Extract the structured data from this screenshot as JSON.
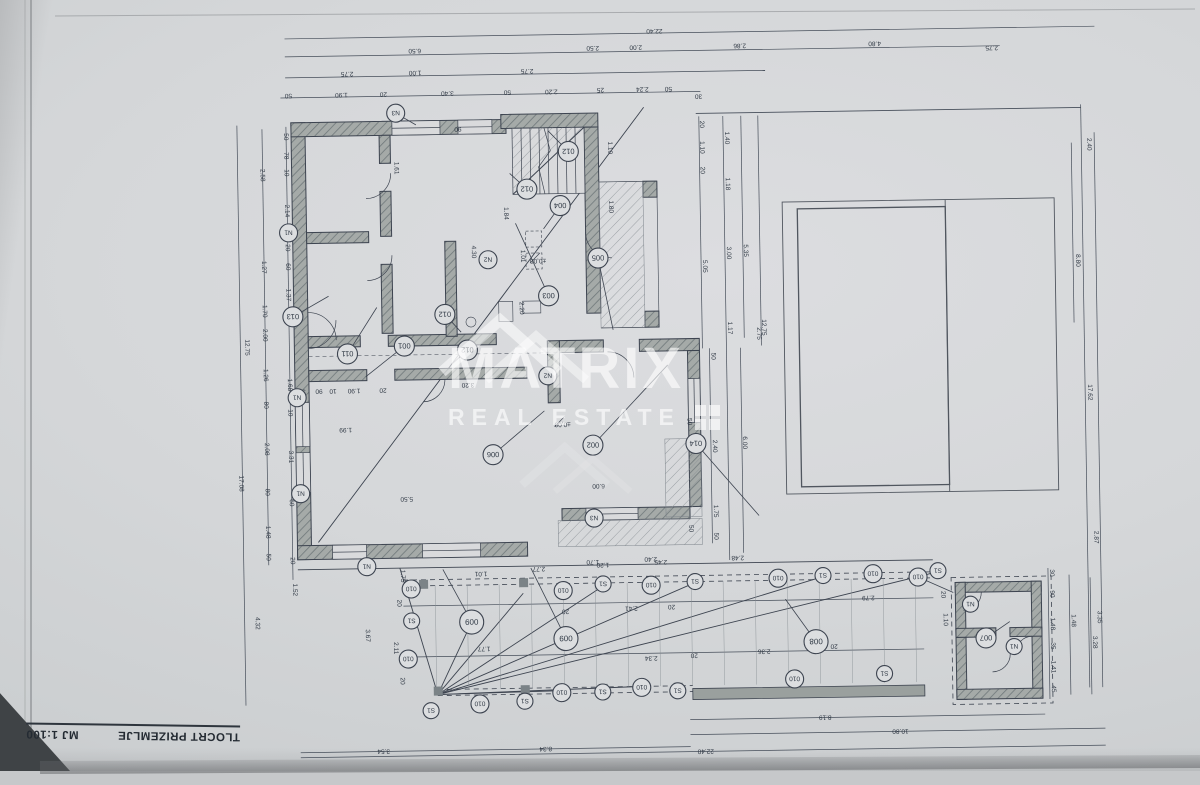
{
  "title_block": {
    "title": "TLOCRT PRIZEMLJE",
    "scale": "MJ 1:100"
  },
  "watermark": {
    "brand": "MATRIX",
    "tagline": "REAL ESTATE"
  },
  "colors": {
    "paper": "#d5d7d9",
    "ink": "#3d4450",
    "wall": "#a5aaa8",
    "hatch": "#6f787a",
    "watermark_white": "rgba(255,255,255,0.62)"
  },
  "levels": [
    {
      "t": "±0,00",
      "x": 540,
      "y": 258
    },
    {
      "t": "±0,00",
      "x": 562,
      "y": 422
    }
  ],
  "tags": [
    {
      "t": "N3",
      "x": 400,
      "y": 110,
      "r": 9,
      "lx": 420,
      "ly": 122
    },
    {
      "t": "N1",
      "x": 291,
      "y": 228,
      "r": 9
    },
    {
      "t": "013",
      "x": 294,
      "y": 312,
      "r": 10,
      "lx": 330,
      "ly": 292
    },
    {
      "t": "011",
      "x": 348,
      "y": 350,
      "r": 10,
      "lx": 378,
      "ly": 304
    },
    {
      "t": "001",
      "x": 405,
      "y": 343,
      "r": 10,
      "lx": 366,
      "ly": 373
    },
    {
      "t": "012",
      "x": 572,
      "y": 151,
      "r": 10,
      "lx": 552,
      "ly": 130
    },
    {
      "t": "012",
      "x": 530,
      "y": 188,
      "r": 10,
      "lx": 513,
      "ly": 172
    },
    {
      "t": "012",
      "x": 446,
      "y": 312,
      "r": 10,
      "lx": 462,
      "ly": 330
    },
    {
      "t": "012",
      "x": 468,
      "y": 348,
      "r": 10,
      "lx": 452,
      "ly": 362
    },
    {
      "t": "004",
      "x": 563,
      "y": 205,
      "r": 10,
      "lx": 546,
      "ly": 228
    },
    {
      "t": "005",
      "x": 600,
      "y": 258,
      "r": 10,
      "lx": 614,
      "ly": 330
    },
    {
      "t": "003",
      "x": 550,
      "y": 295,
      "r": 10,
      "lx": 518,
      "ly": 222
    },
    {
      "t": "006",
      "x": 492,
      "y": 453,
      "r": 10,
      "lx": 544,
      "ly": 410
    },
    {
      "t": "002",
      "x": 592,
      "y": 445,
      "r": 10,
      "lx": 668,
      "ly": 366
    },
    {
      "t": "014",
      "x": 695,
      "y": 445,
      "r": 10,
      "lx": 757,
      "ly": 518
    },
    {
      "t": "N2",
      "x": 490,
      "y": 258,
      "r": 9
    },
    {
      "t": "N2",
      "x": 548,
      "y": 375,
      "r": 9
    },
    {
      "t": "N3",
      "x": 592,
      "y": 518,
      "r": 9
    },
    {
      "t": "N1",
      "x": 297,
      "y": 393,
      "r": 9
    },
    {
      "t": "N1",
      "x": 299,
      "y": 489,
      "r": 9
    },
    {
      "t": "N1",
      "x": 364,
      "y": 563,
      "r": 9
    },
    {
      "t": "N1",
      "x": 967,
      "y": 610,
      "r": 8
    },
    {
      "t": "N1",
      "x": 1010,
      "y": 653,
      "r": 8
    },
    {
      "t": "007",
      "x": 982,
      "y": 644,
      "r": 10,
      "lx": 1006,
      "ly": 628
    },
    {
      "t": "010",
      "x": 915,
      "y": 582,
      "r": 9,
      "lx": 950,
      "ly": 598
    },
    {
      "t": "010",
      "x": 408,
      "y": 586,
      "r": 9
    },
    {
      "t": "S1",
      "x": 408,
      "y": 618,
      "r": 8
    },
    {
      "t": "010",
      "x": 404,
      "y": 656,
      "r": 9
    },
    {
      "t": "S1",
      "x": 426,
      "y": 708,
      "r": 8
    },
    {
      "t": "010",
      "x": 560,
      "y": 590,
      "r": 9
    },
    {
      "t": "S1",
      "x": 600,
      "y": 584,
      "r": 8
    },
    {
      "t": "010",
      "x": 648,
      "y": 586,
      "r": 9
    },
    {
      "t": "S1",
      "x": 692,
      "y": 583,
      "r": 8
    },
    {
      "t": "010",
      "x": 775,
      "y": 581,
      "r": 9
    },
    {
      "t": "S1",
      "x": 820,
      "y": 579,
      "r": 8
    },
    {
      "t": "010",
      "x": 870,
      "y": 578,
      "r": 9
    },
    {
      "t": "S1",
      "x": 935,
      "y": 576,
      "r": 8
    },
    {
      "t": "010",
      "x": 475,
      "y": 702,
      "r": 9
    },
    {
      "t": "S1",
      "x": 520,
      "y": 700,
      "r": 8
    },
    {
      "t": "010",
      "x": 557,
      "y": 692,
      "r": 9
    },
    {
      "t": "S1",
      "x": 598,
      "y": 692,
      "r": 8
    },
    {
      "t": "010",
      "x": 637,
      "y": 688,
      "r": 9
    },
    {
      "t": "S1",
      "x": 673,
      "y": 692,
      "r": 8
    },
    {
      "t": "010",
      "x": 790,
      "y": 682,
      "r": 9
    },
    {
      "t": "S1",
      "x": 880,
      "y": 678,
      "r": 8
    },
    {
      "t": "009",
      "x": 468,
      "y": 620,
      "r": 12,
      "lx": 440,
      "ly": 567
    },
    {
      "t": "009",
      "x": 562,
      "y": 638,
      "r": 12,
      "lx": 528,
      "ly": 567
    },
    {
      "t": "008",
      "x": 812,
      "y": 645,
      "r": 12,
      "lx": 782,
      "ly": 602
    }
  ],
  "dims": [
    {
      "t": "22.40",
      "x": 660,
      "y": 30,
      "o": "h"
    },
    {
      "t": "6.50",
      "x": 420,
      "y": 46,
      "o": "h"
    },
    {
      "t": "2.50",
      "x": 598,
      "y": 46,
      "o": "h"
    },
    {
      "t": "2.00",
      "x": 641,
      "y": 46,
      "o": "h"
    },
    {
      "t": "2.86",
      "x": 745,
      "y": 46,
      "o": "h"
    },
    {
      "t": "4.80",
      "x": 880,
      "y": 46,
      "o": "h"
    },
    {
      "t": "2.75",
      "x": 997,
      "y": 52,
      "o": "h"
    },
    {
      "t": "2.75",
      "x": 352,
      "y": 68,
      "o": "h"
    },
    {
      "t": "1.00",
      "x": 420,
      "y": 68,
      "o": "h"
    },
    {
      "t": "2.75",
      "x": 532,
      "y": 68,
      "o": "h"
    },
    {
      "t": "25",
      "x": 605,
      "y": 88,
      "o": "h"
    },
    {
      "t": "2.24",
      "x": 647,
      "y": 88,
      "o": "h"
    },
    {
      "t": "50",
      "x": 673,
      "y": 88,
      "o": "h"
    },
    {
      "t": "50",
      "x": 293,
      "y": 89,
      "o": "h"
    },
    {
      "t": "1.90",
      "x": 346,
      "y": 89,
      "o": "h"
    },
    {
      "t": "20",
      "x": 388,
      "y": 89,
      "o": "h"
    },
    {
      "t": "3.40",
      "x": 452,
      "y": 89,
      "o": "h"
    },
    {
      "t": "50",
      "x": 512,
      "y": 89,
      "o": "h"
    },
    {
      "t": "2.20",
      "x": 556,
      "y": 89,
      "o": "h"
    },
    {
      "t": "30",
      "x": 703,
      "y": 96,
      "o": "h"
    },
    {
      "t": "2.40",
      "x": 1091,
      "y": 152,
      "o": "v"
    },
    {
      "t": "12.75",
      "x": 246,
      "y": 342,
      "o": "v"
    },
    {
      "t": "17.08",
      "x": 238,
      "y": 478,
      "o": "v"
    },
    {
      "t": "2.58",
      "x": 264,
      "y": 170,
      "o": "v"
    },
    {
      "t": "1.27",
      "x": 264,
      "y": 262,
      "o": "v"
    },
    {
      "t": "1.70",
      "x": 264,
      "y": 306,
      "o": "v"
    },
    {
      "t": "2.00",
      "x": 264,
      "y": 330,
      "o": "v"
    },
    {
      "t": "1.26",
      "x": 264,
      "y": 370,
      "o": "v"
    },
    {
      "t": "80",
      "x": 264,
      "y": 400,
      "o": "v"
    },
    {
      "t": "2.08",
      "x": 264,
      "y": 444,
      "o": "v"
    },
    {
      "t": "80",
      "x": 264,
      "y": 487,
      "o": "v"
    },
    {
      "t": "1.48",
      "x": 264,
      "y": 527,
      "o": "v"
    },
    {
      "t": "50",
      "x": 264,
      "y": 552,
      "o": "v"
    },
    {
      "t": "50",
      "x": 288,
      "y": 132,
      "o": "v"
    },
    {
      "t": "78",
      "x": 288,
      "y": 151,
      "o": "v"
    },
    {
      "t": "10",
      "x": 288,
      "y": 168,
      "o": "v"
    },
    {
      "t": "2.14",
      "x": 288,
      "y": 206,
      "o": "v"
    },
    {
      "t": "20",
      "x": 288,
      "y": 243,
      "o": "v"
    },
    {
      "t": "60",
      "x": 288,
      "y": 262,
      "o": "v"
    },
    {
      "t": "1.37",
      "x": 288,
      "y": 290,
      "o": "v"
    },
    {
      "t": "1.68",
      "x": 288,
      "y": 380,
      "o": "v"
    },
    {
      "t": "10",
      "x": 288,
      "y": 408,
      "o": "v"
    },
    {
      "t": "3.31",
      "x": 288,
      "y": 452,
      "o": "v"
    },
    {
      "t": "60",
      "x": 288,
      "y": 498,
      "o": "v"
    },
    {
      "t": "20",
      "x": 288,
      "y": 556,
      "o": "v"
    },
    {
      "t": "1.52",
      "x": 290,
      "y": 585,
      "o": "v"
    },
    {
      "t": "4.32",
      "x": 252,
      "y": 618,
      "o": "v"
    },
    {
      "t": "1.61",
      "x": 398,
      "y": 165,
      "o": "v"
    },
    {
      "t": "4.30",
      "x": 474,
      "y": 250,
      "o": "v"
    },
    {
      "t": "90",
      "x": 462,
      "y": 125,
      "o": "h"
    },
    {
      "t": "1.10",
      "x": 612,
      "y": 148,
      "o": "v"
    },
    {
      "t": "1.80",
      "x": 612,
      "y": 207,
      "o": "v"
    },
    {
      "t": "1.01",
      "x": 523,
      "y": 255,
      "o": "v"
    },
    {
      "t": "2.20",
      "x": 521,
      "y": 307,
      "o": "v"
    },
    {
      "t": "1.84",
      "x": 507,
      "y": 212,
      "o": "v"
    },
    {
      "t": "35",
      "x": 302,
      "y": 385,
      "o": "h"
    },
    {
      "t": "90",
      "x": 319,
      "y": 385,
      "o": "h"
    },
    {
      "t": "10",
      "x": 333,
      "y": 385,
      "o": "h"
    },
    {
      "t": "1.90",
      "x": 354,
      "y": 385,
      "o": "h"
    },
    {
      "t": "20",
      "x": 383,
      "y": 385,
      "o": "h"
    },
    {
      "t": "3.20",
      "x": 468,
      "y": 381,
      "o": "h"
    },
    {
      "t": "1.99",
      "x": 345,
      "y": 424,
      "o": "h"
    },
    {
      "t": "5.50",
      "x": 405,
      "y": 494,
      "o": "h"
    },
    {
      "t": "6.00",
      "x": 597,
      "y": 484,
      "o": "h"
    },
    {
      "t": "1.70",
      "x": 590,
      "y": 560,
      "o": "h"
    },
    {
      "t": "2.40",
      "x": 648,
      "y": 558,
      "o": "h"
    },
    {
      "t": "50",
      "x": 687,
      "y": 423,
      "o": "v"
    },
    {
      "t": "50",
      "x": 687,
      "y": 530,
      "o": "v"
    },
    {
      "t": "20",
      "x": 704,
      "y": 126,
      "o": "v"
    },
    {
      "t": "1.10",
      "x": 704,
      "y": 149,
      "o": "v"
    },
    {
      "t": "20",
      "x": 704,
      "y": 172,
      "o": "v"
    },
    {
      "t": "5.05",
      "x": 705,
      "y": 268,
      "o": "v"
    },
    {
      "t": "1.40",
      "x": 729,
      "y": 140,
      "o": "v"
    },
    {
      "t": "1.18",
      "x": 729,
      "y": 186,
      "o": "v"
    },
    {
      "t": "3.00",
      "x": 729,
      "y": 255,
      "o": "v"
    },
    {
      "t": "1.17",
      "x": 729,
      "y": 330,
      "o": "v"
    },
    {
      "t": "5.35",
      "x": 746,
      "y": 253,
      "o": "v"
    },
    {
      "t": "12.75",
      "x": 763,
      "y": 330,
      "o": "v"
    },
    {
      "t": "2.75",
      "x": 758,
      "y": 336,
      "o": "v"
    },
    {
      "t": "50",
      "x": 712,
      "y": 358,
      "o": "v"
    },
    {
      "t": "2.40",
      "x": 712,
      "y": 448,
      "o": "v"
    },
    {
      "t": "6.00",
      "x": 742,
      "y": 445,
      "o": "v"
    },
    {
      "t": "1.75",
      "x": 712,
      "y": 513,
      "o": "v"
    },
    {
      "t": "50",
      "x": 712,
      "y": 538,
      "o": "v"
    },
    {
      "t": "8.80",
      "x": 1078,
      "y": 268,
      "o": "v"
    },
    {
      "t": "17.62",
      "x": 1088,
      "y": 400,
      "o": "v"
    },
    {
      "t": "2.87",
      "x": 1092,
      "y": 545,
      "o": "v"
    },
    {
      "t": "3.35",
      "x": 1094,
      "y": 625,
      "o": "v"
    },
    {
      "t": "1.75",
      "x": 398,
      "y": 573,
      "o": "v"
    },
    {
      "t": "20",
      "x": 394,
      "y": 600,
      "o": "v"
    },
    {
      "t": "3.67",
      "x": 362,
      "y": 632,
      "o": "v"
    },
    {
      "t": "2.11",
      "x": 390,
      "y": 645,
      "o": "v"
    },
    {
      "t": "20",
      "x": 396,
      "y": 678,
      "o": "v"
    },
    {
      "t": "1.01",
      "x": 478,
      "y": 570,
      "o": "h"
    },
    {
      "t": "2.77",
      "x": 536,
      "y": 566,
      "o": "h"
    },
    {
      "t": "1.20",
      "x": 600,
      "y": 563,
      "o": "h"
    },
    {
      "t": "2.45",
      "x": 658,
      "y": 561,
      "o": "h"
    },
    {
      "t": "2.48",
      "x": 735,
      "y": 558,
      "o": "h"
    },
    {
      "t": "20",
      "x": 562,
      "y": 609,
      "o": "h"
    },
    {
      "t": "2.41",
      "x": 628,
      "y": 607,
      "o": "h"
    },
    {
      "t": "20",
      "x": 668,
      "y": 606,
      "o": "h"
    },
    {
      "t": "2.79",
      "x": 865,
      "y": 600,
      "o": "h"
    },
    {
      "t": "1.77",
      "x": 480,
      "y": 645,
      "o": "h"
    },
    {
      "t": "2.34",
      "x": 647,
      "y": 657,
      "o": "h"
    },
    {
      "t": "20",
      "x": 690,
      "y": 655,
      "o": "h"
    },
    {
      "t": "2.36",
      "x": 760,
      "y": 652,
      "o": "h"
    },
    {
      "t": "20",
      "x": 830,
      "y": 648,
      "o": "h"
    },
    {
      "t": "8.19",
      "x": 820,
      "y": 719,
      "o": "h"
    },
    {
      "t": "10.80",
      "x": 895,
      "y": 734,
      "o": "h"
    },
    {
      "t": "22.40",
      "x": 700,
      "y": 751,
      "o": "h"
    },
    {
      "t": "3.54",
      "x": 378,
      "y": 746,
      "o": "h"
    },
    {
      "t": "8.34",
      "x": 540,
      "y": 746,
      "o": "h"
    },
    {
      "t": "30",
      "x": 1047,
      "y": 580,
      "o": "v"
    },
    {
      "t": "90",
      "x": 1047,
      "y": 601,
      "o": "v"
    },
    {
      "t": "1.48",
      "x": 1047,
      "y": 631,
      "o": "v"
    },
    {
      "t": "35",
      "x": 1047,
      "y": 653,
      "o": "v"
    },
    {
      "t": "1.41",
      "x": 1047,
      "y": 674,
      "o": "v"
    },
    {
      "t": "45",
      "x": 1047,
      "y": 696,
      "o": "v"
    },
    {
      "t": "1.48",
      "x": 1068,
      "y": 628,
      "o": "v"
    },
    {
      "t": "3.28",
      "x": 1089,
      "y": 650,
      "o": "v"
    },
    {
      "t": "20",
      "x": 938,
      "y": 600,
      "o": "v"
    },
    {
      "t": "1.10",
      "x": 940,
      "y": 625,
      "o": "v"
    }
  ]
}
